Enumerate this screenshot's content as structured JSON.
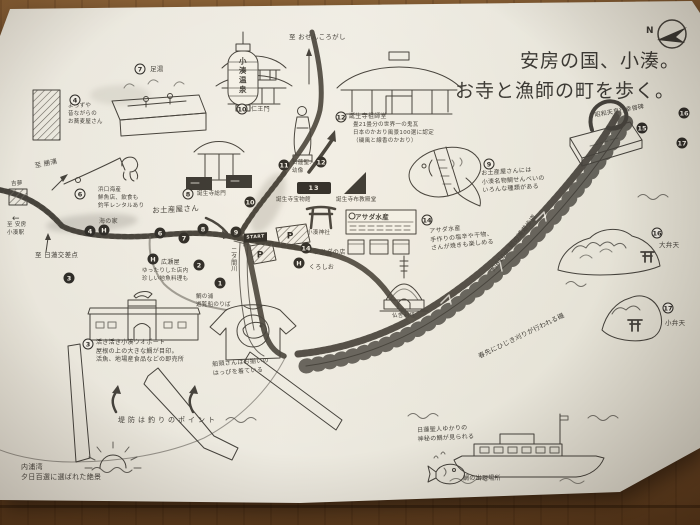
{
  "title": {
    "line1": "安房の国、小湊。",
    "line2": "お寺と漁師の町を歩く。"
  },
  "compass": {
    "label": "N"
  },
  "route": {
    "start_label": "START"
  },
  "colors": {
    "ink": "#45423c",
    "route": "#57534b",
    "paper": "#eae7dc",
    "marker_black": "#2e2c28"
  },
  "map_labels": [
    {
      "t": "至 おせんころがし",
      "x": 289,
      "y": 33,
      "s": 6.5
    },
    {
      "t": "昭和天皇行幸啓碑",
      "x": 594,
      "y": 112,
      "s": 6,
      "r": -10
    },
    {
      "t": "お土産屋さんには\n小湊名物鯛せんべいの\nいろんな種類がある",
      "x": 481,
      "y": 170,
      "s": 6,
      "r": -4
    },
    {
      "t": "アサダ水産\n手作りの塩辛や干物、\nさんが焼きも楽しめる",
      "x": 429,
      "y": 228,
      "s": 6,
      "r": -6
    },
    {
      "t": "約610m 鯛の浦遊歩道",
      "x": 489,
      "y": 268,
      "s": 6.5,
      "r": -52
    },
    {
      "t": "春先にひじき刈りが行われる磯",
      "x": 477,
      "y": 353,
      "s": 6.5,
      "r": -26
    },
    {
      "t": "大弁天",
      "x": 659,
      "y": 241,
      "s": 6.5
    },
    {
      "t": "小弁天",
      "x": 665,
      "y": 319,
      "s": 6.5
    },
    {
      "t": "仏舎利塔",
      "x": 392,
      "y": 313,
      "s": 5.5
    },
    {
      "t": "誕生寺宝物館",
      "x": 276,
      "y": 197,
      "s": 5.5
    },
    {
      "t": "誕生寺布教殿堂",
      "x": 336,
      "y": 197,
      "s": 5.5
    },
    {
      "t": "小湊神社",
      "x": 307,
      "y": 230,
      "s": 5.5
    },
    {
      "t": "アサダの店",
      "x": 314,
      "y": 249,
      "s": 6
    },
    {
      "t": "くろしお",
      "x": 309,
      "y": 264,
      "s": 6
    },
    {
      "t": "二タ間川",
      "x": 229,
      "y": 247,
      "s": 6,
      "v": true
    },
    {
      "t": "誕生寺総門",
      "x": 197,
      "y": 191,
      "s": 5.5
    },
    {
      "t": "仁王門",
      "x": 251,
      "y": 106,
      "s": 6
    },
    {
      "t": "足湯",
      "x": 150,
      "y": 65,
      "s": 6.5
    },
    {
      "t": "小湊温泉",
      "x": 238,
      "y": 57,
      "s": 7.5,
      "v": true,
      "ls": 2,
      "b": true
    },
    {
      "t": "日蓮聖人\n幼像",
      "x": 292,
      "y": 160,
      "s": 5.5
    },
    {
      "t": "誕生寺祖師堂",
      "x": 349,
      "y": 113,
      "s": 6
    },
    {
      "t": "畳21畳分の世界一の鬼瓦\n日本のかおり風景100選に認定\n（磯風と線香のかおり）",
      "x": 353,
      "y": 122,
      "s": 5.5
    },
    {
      "t": "よろずや\n昔ながらの\nお蕎麦屋さん",
      "x": 68,
      "y": 103,
      "s": 5.5
    },
    {
      "t": "浜口海産\n鮮魚店、飲食も\n釣竿レンタルあり",
      "x": 98,
      "y": 187,
      "s": 5.5
    },
    {
      "t": "海の家",
      "x": 99,
      "y": 218,
      "s": 6
    },
    {
      "t": "お土産屋さん",
      "x": 152,
      "y": 206,
      "s": 7.5,
      "r": -3
    },
    {
      "t": "広瀬屋",
      "x": 161,
      "y": 259,
      "s": 6
    },
    {
      "t": "ゆったりした店内\n珍しい地魚料理も",
      "x": 142,
      "y": 268,
      "s": 5.5
    },
    {
      "t": "活き活き小湊ウオポート\n屋根の上の大きな鯛が目印。\n活魚、地場産食品などの即売所",
      "x": 96,
      "y": 339,
      "s": 6
    },
    {
      "t": "鯛の浦\n遊覧船のりば",
      "x": 196,
      "y": 294,
      "s": 5.5
    },
    {
      "t": "船頭さんはお揃いの\nはっぴを着ている",
      "x": 212,
      "y": 361,
      "s": 6,
      "r": -4
    },
    {
      "t": "堤防は釣りのポイント",
      "x": 118,
      "y": 415,
      "s": 7,
      "ls": 3
    },
    {
      "t": "内浦湾\n夕日百選に選ばれた絶景",
      "x": 21,
      "y": 462,
      "s": 7
    },
    {
      "t": "日蓮聖人ゆかりの\n神秘の鯛が見られる",
      "x": 417,
      "y": 427,
      "s": 6,
      "r": -3
    },
    {
      "t": "鯛の出現場所",
      "x": 463,
      "y": 475,
      "s": 6
    },
    {
      "t": "至 勝浦",
      "x": 34,
      "y": 162,
      "s": 6.5,
      "r": -12
    },
    {
      "t": "至 日蓮交差点",
      "x": 35,
      "y": 251,
      "s": 6.5
    },
    {
      "t": "←",
      "x": 12,
      "y": 213,
      "s": 9
    },
    {
      "t": "至 安房\n小湊駅",
      "x": 7,
      "y": 222,
      "s": 5.5
    },
    {
      "t": "吉夢",
      "x": 11,
      "y": 181,
      "s": 5.5
    },
    {
      "t": "アサダ水産",
      "x": 355,
      "y": 213,
      "s": 6.5,
      "b": true
    }
  ],
  "markers": [
    {
      "n": "7",
      "x": 140,
      "y": 69,
      "style": "open"
    },
    {
      "n": "10",
      "x": 242,
      "y": 109,
      "style": "open"
    },
    {
      "n": "12",
      "x": 341,
      "y": 117,
      "style": "open"
    },
    {
      "n": "8",
      "x": 188,
      "y": 194,
      "style": "open"
    },
    {
      "n": "9",
      "x": 489,
      "y": 164,
      "style": "open"
    },
    {
      "n": "14",
      "x": 427,
      "y": 220,
      "style": "open"
    },
    {
      "n": "3",
      "x": 88,
      "y": 344,
      "style": "open"
    },
    {
      "n": "4",
      "x": 75,
      "y": 100,
      "style": "open"
    },
    {
      "n": "6",
      "x": 80,
      "y": 194,
      "style": "open"
    },
    {
      "n": "16",
      "x": 657,
      "y": 233,
      "style": "open"
    },
    {
      "n": "17",
      "x": 668,
      "y": 308,
      "style": "open"
    },
    {
      "n": "1",
      "x": 220,
      "y": 283,
      "style": "filled"
    },
    {
      "n": "2",
      "x": 199,
      "y": 265,
      "style": "filled"
    },
    {
      "n": "3",
      "x": 69,
      "y": 278,
      "style": "filled"
    },
    {
      "n": "4",
      "x": 90,
      "y": 231,
      "style": "filled"
    },
    {
      "n": "6",
      "x": 160,
      "y": 233,
      "style": "filled"
    },
    {
      "n": "7",
      "x": 184,
      "y": 238,
      "style": "filled"
    },
    {
      "n": "8",
      "x": 203,
      "y": 229,
      "style": "filled"
    },
    {
      "n": "9",
      "x": 236,
      "y": 232,
      "style": "filled"
    },
    {
      "n": "10",
      "x": 250,
      "y": 202,
      "style": "filled"
    },
    {
      "n": "11",
      "x": 284,
      "y": 165,
      "style": "filled"
    },
    {
      "n": "12",
      "x": 321,
      "y": 162,
      "style": "filled"
    },
    {
      "n": "13",
      "x": 314,
      "y": 188,
      "style": "box"
    },
    {
      "n": "14",
      "x": 306,
      "y": 248,
      "style": "filled"
    },
    {
      "n": "15",
      "x": 642,
      "y": 128,
      "style": "filled"
    },
    {
      "n": "16",
      "x": 684,
      "y": 113,
      "style": "filled"
    },
    {
      "n": "17",
      "x": 682,
      "y": 143,
      "style": "filled"
    },
    {
      "n": "H",
      "x": 104,
      "y": 230,
      "style": "filled"
    },
    {
      "n": "H",
      "x": 153,
      "y": 259,
      "style": "filled"
    },
    {
      "n": "H",
      "x": 299,
      "y": 263,
      "style": "filled"
    },
    {
      "n": "P",
      "x": 260,
      "y": 255,
      "style": "p"
    },
    {
      "n": "P",
      "x": 290,
      "y": 236,
      "style": "p"
    }
  ]
}
